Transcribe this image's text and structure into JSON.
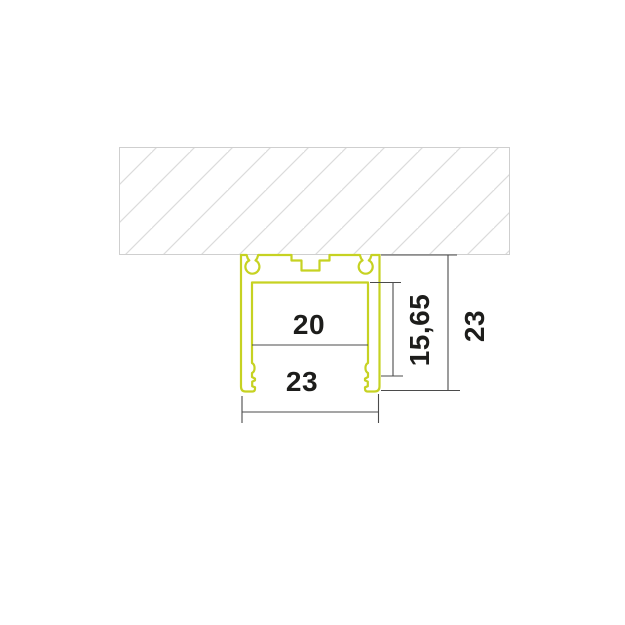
{
  "dimensions": {
    "inner_width": {
      "value": "20"
    },
    "bottom_width": {
      "value": "23"
    },
    "inner_height": {
      "value": "15,65"
    },
    "outer_height": {
      "value": "23"
    }
  },
  "colors": {
    "profile_stroke": "#c6d222",
    "dimension_line": "#4b4b4b",
    "label_text": "#1d1d1b",
    "hatch_line": "#dcdcdc",
    "hatch_border": "#cfcfcf",
    "background": "#ffffff"
  }
}
